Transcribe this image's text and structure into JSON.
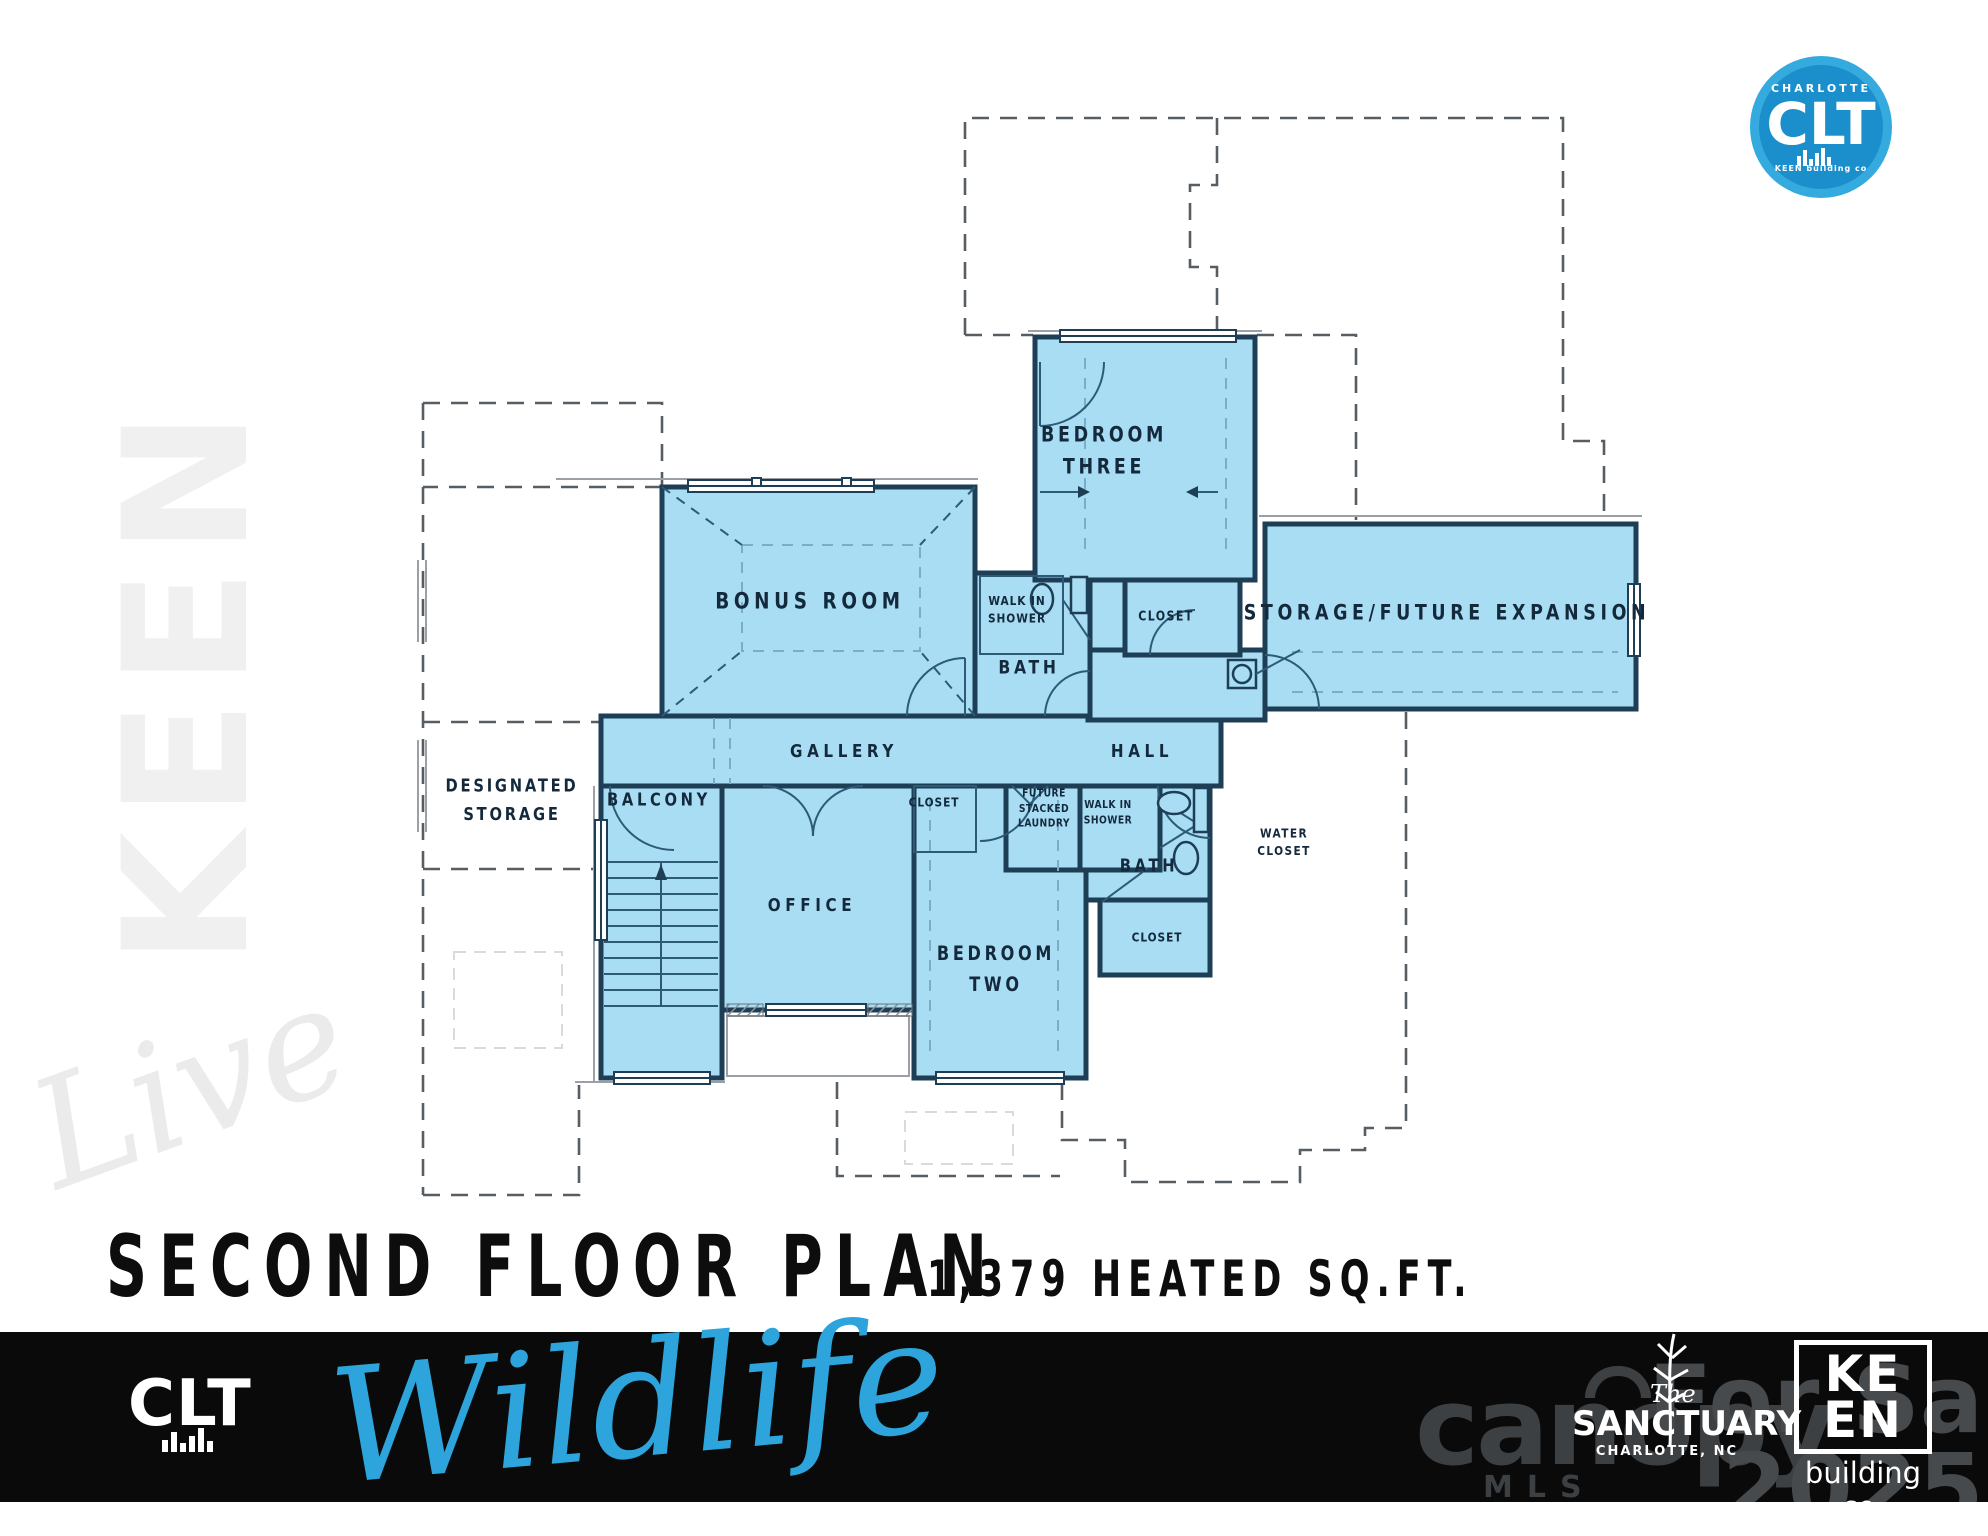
{
  "badge": {
    "city": "CHARLOTTE",
    "brand": "CLT",
    "sub": "KEEN building co"
  },
  "side": {
    "brand": "KEEN",
    "script": "Live"
  },
  "plan": {
    "labels": {
      "bonus_room": "BONUS ROOM",
      "walk_in_shower_upper": "WALK IN\nSHOWER",
      "bath_upper": "BATH",
      "bedroom_three": "BEDROOM\nTHREE",
      "closet_bedroom_three": "CLOSET",
      "storage_future_expansion": "STORAGE/FUTURE EXPANSION",
      "gallery": "GALLERY",
      "hall": "HALL",
      "designated_storage": "DESIGNATED\nSTORAGE",
      "balcony": "BALCONY",
      "closet_gallery": "CLOSET",
      "future_stacked_laundry": "FUTURE\nSTACKED\nLAUNDRY",
      "walk_in_shower_lower": "WALK IN\nSHOWER",
      "bath_lower": "BATH",
      "water_closet": "WATER\nCLOSET",
      "office": "OFFICE",
      "bedroom_two": "BEDROOM\nTWO",
      "closet_bedroom_two": "CLOSET"
    }
  },
  "title": {
    "main": "SECOND FLOOR PLAN",
    "sqft": "1,379 HEATED SQ.FT."
  },
  "footer": {
    "clt": "CLT",
    "tagline": "Wildlife",
    "canopy": "canopy",
    "canopy_sub": "MLS",
    "watermark_line1": "For Sale",
    "watermark_line2": "2025",
    "sanctuary_the": "The",
    "sanctuary_name": "SANCTUARY",
    "sanctuary_city": "CHARLOTTE, NC",
    "keen_logo": "KE\nEN",
    "keen_sub": "building co."
  },
  "colors": {
    "room_fill": "#a8ddf3",
    "wall": "#1d3e55",
    "accent_blue": "#2da4dc",
    "badge_blue": "#1b8fcb",
    "footer_bar": "#0a0a0a"
  }
}
